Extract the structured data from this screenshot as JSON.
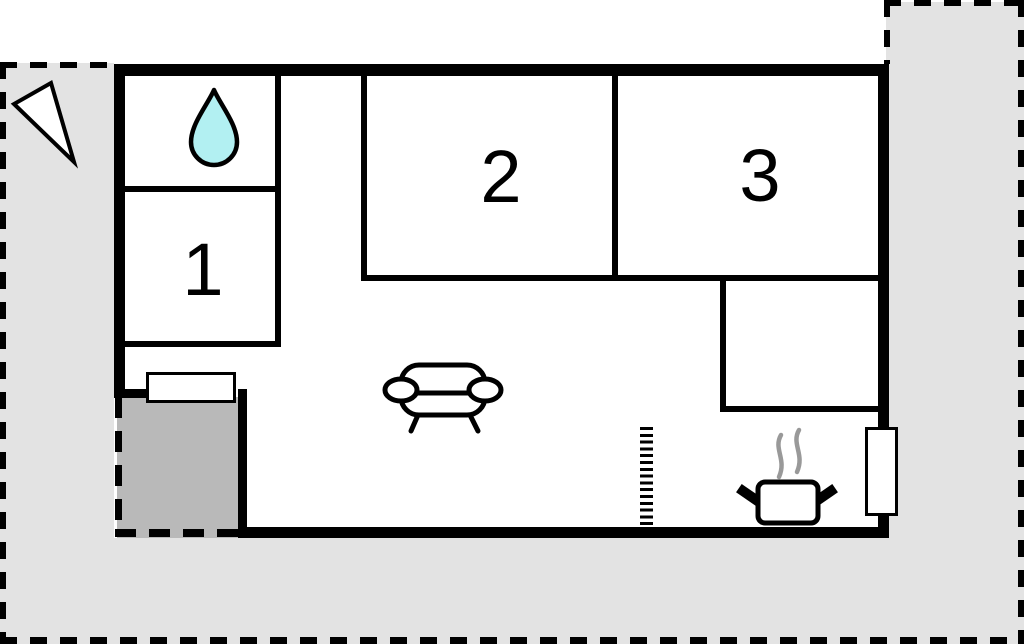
{
  "floorplan": {
    "kind": "apartment-floor-plan",
    "rooms": {
      "room1": {
        "label": "1"
      },
      "room2": {
        "label": "2"
      },
      "room3": {
        "label": "3"
      }
    },
    "icons": [
      "north-arrow-icon",
      "water-drop-icon",
      "sofa-icon",
      "cooking-pot-icon",
      "steam-icon"
    ],
    "features": [
      "bathroom",
      "living-area",
      "kitchen-corner",
      "storage-room",
      "entrance-door",
      "window",
      "terrace",
      "room-opening",
      "plot-boundary"
    ],
    "colors": {
      "wall": "#000000",
      "interior": "#ffffff",
      "outdoor_area": "#e3e3e3",
      "terrace": "#b9b9b9",
      "water_drop_fill": "#b2f0f2",
      "steam": "#999999"
    }
  }
}
